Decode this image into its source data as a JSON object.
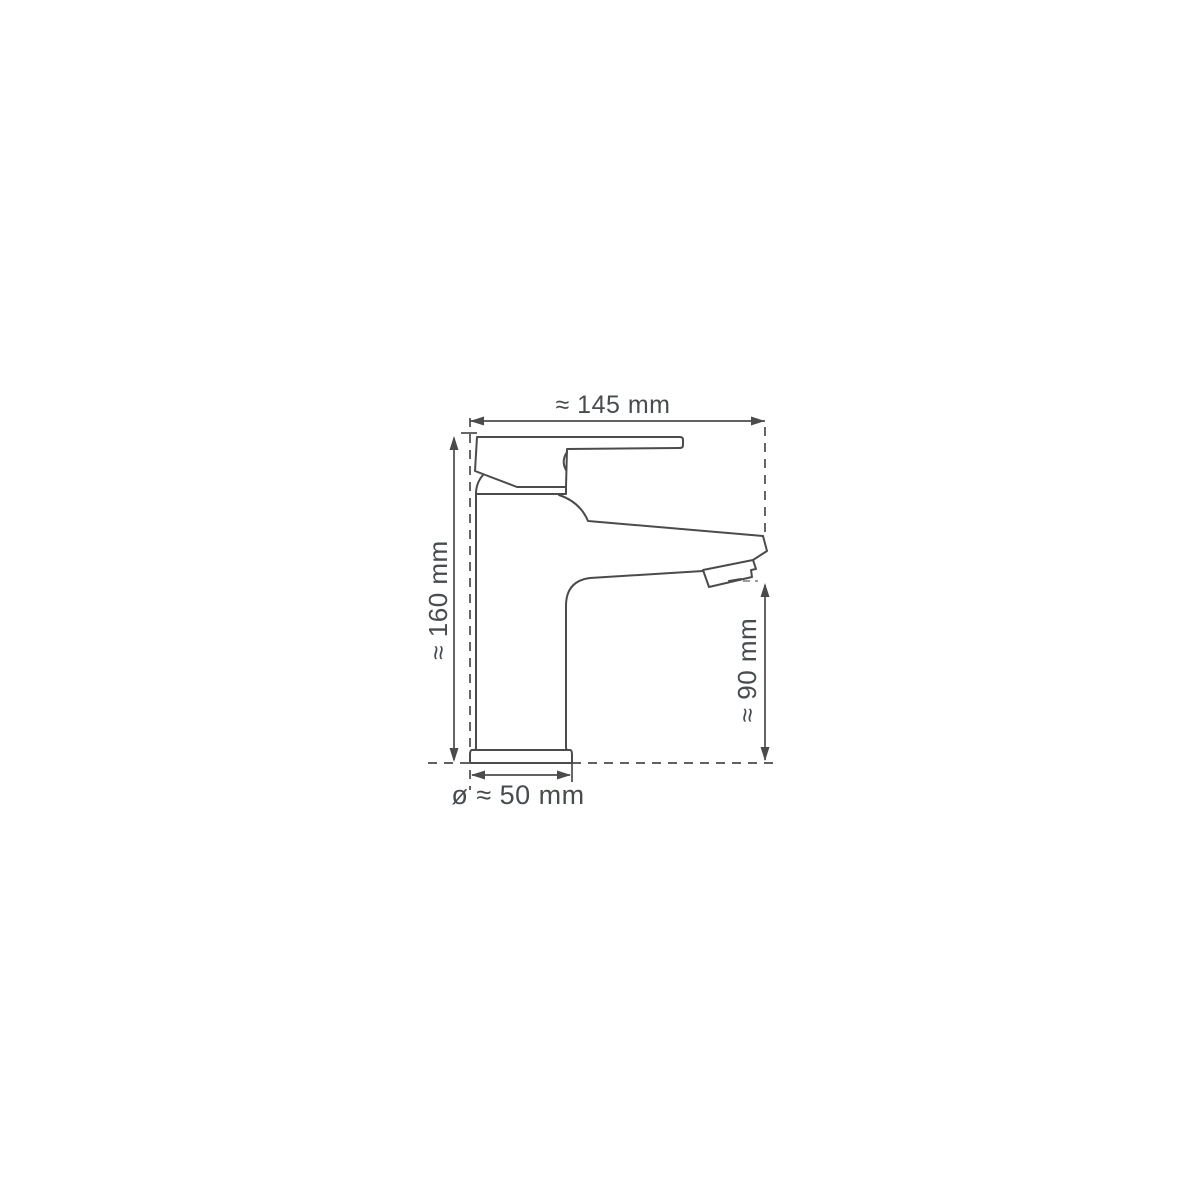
{
  "drawing": {
    "background_color": "#ffffff",
    "line_color": "#4b4b4b",
    "text_color": "#474c4f",
    "labels": {
      "width": "≈ 145 mm",
      "height": "≈ 160 mm",
      "spout_height": "≈ 90 mm",
      "base_diameter": "ø ≈ 50 mm"
    }
  }
}
